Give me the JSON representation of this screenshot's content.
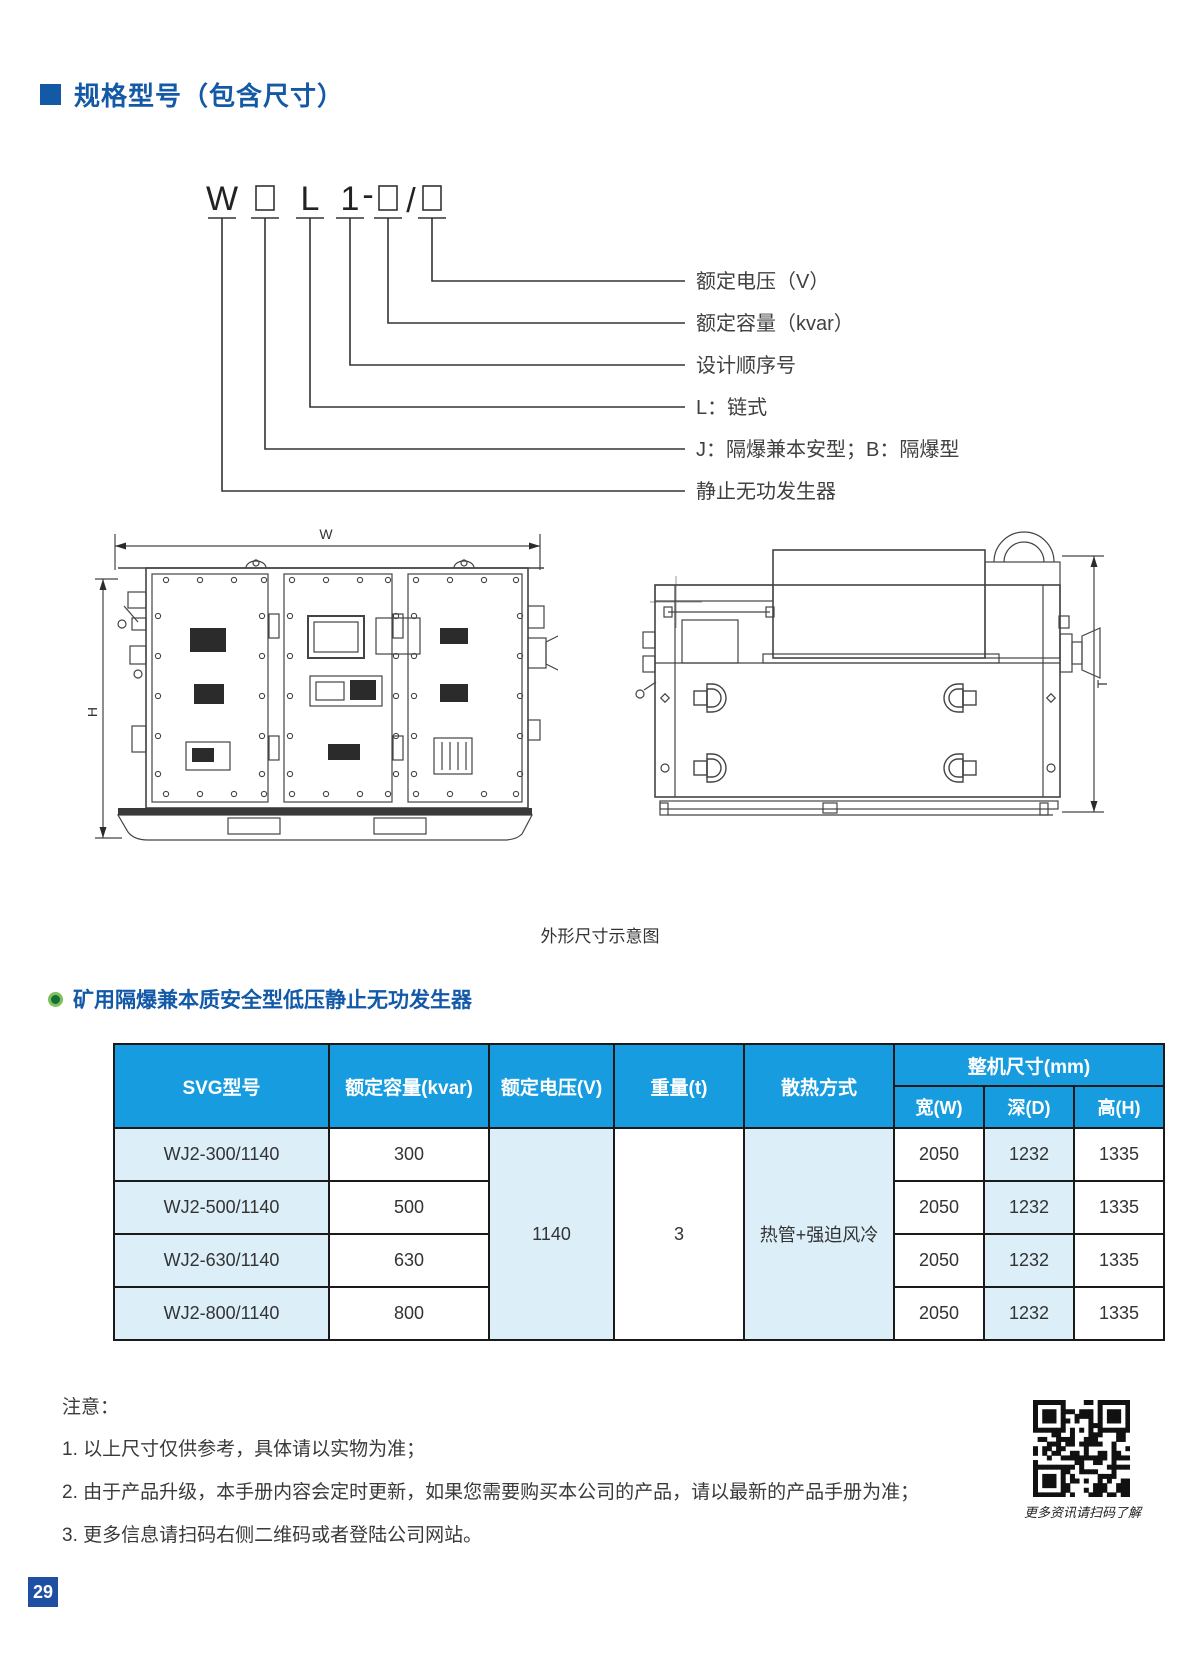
{
  "header": {
    "title": "规格型号（包含尺寸）"
  },
  "model_diagram": {
    "code": {
      "w": "W",
      "l": "L",
      "seq": "1",
      "dash": "-",
      "slash": "/"
    },
    "labels": [
      "额定电压（V）",
      "额定容量（kvar）",
      "设计顺序号",
      "L：链式",
      "J：隔爆兼本安型；B：隔爆型",
      "静止无功发生器"
    ]
  },
  "drawing": {
    "caption": "外形尺寸示意图",
    "dims": {
      "width": "W",
      "height": "H",
      "depth": "T"
    }
  },
  "section": {
    "title": "矿用隔爆兼本质安全型低压静止无功发生器"
  },
  "table": {
    "headers": {
      "model": "SVG型号",
      "capacity": "额定容量(kvar)",
      "voltage": "额定电压(V)",
      "weight": "重量(t)",
      "cooling": "散热方式",
      "dims_group": "整机尺寸(mm)",
      "dim_w": "宽(W)",
      "dim_d": "深(D)",
      "dim_h": "高(H)"
    },
    "merged": {
      "voltage": "1140",
      "weight": "3",
      "cooling": "热管+强迫风冷"
    },
    "rows": [
      {
        "model": "WJ2-300/1140",
        "capacity": "300",
        "w": "2050",
        "d": "1232",
        "h": "1335"
      },
      {
        "model": "WJ2-500/1140",
        "capacity": "500",
        "w": "2050",
        "d": "1232",
        "h": "1335"
      },
      {
        "model": "WJ2-630/1140",
        "capacity": "630",
        "w": "2050",
        "d": "1232",
        "h": "1335"
      },
      {
        "model": "WJ2-800/1140",
        "capacity": "800",
        "w": "2050",
        "d": "1232",
        "h": "1335"
      }
    ]
  },
  "notes": {
    "title": "注意：",
    "items": [
      "1. 以上尺寸仅供参考，具体请以实物为准；",
      "2. 由于产品升级，本手册内容会定时更新，如果您需要购买本公司的产品，请以最新的产品手册为准；",
      "3. 更多信息请扫码右侧二维码或者登陆公司网站。"
    ]
  },
  "qr": {
    "caption": "更多资讯请扫码了解"
  },
  "footer": {
    "page_number": "29"
  },
  "colors": {
    "brand_blue": "#1459A6",
    "table_header_blue": "#189CE0",
    "table_cell_blue": "#DCEEF8",
    "badge_blue": "#1E4FA3",
    "bullet_green": "#166F39"
  }
}
